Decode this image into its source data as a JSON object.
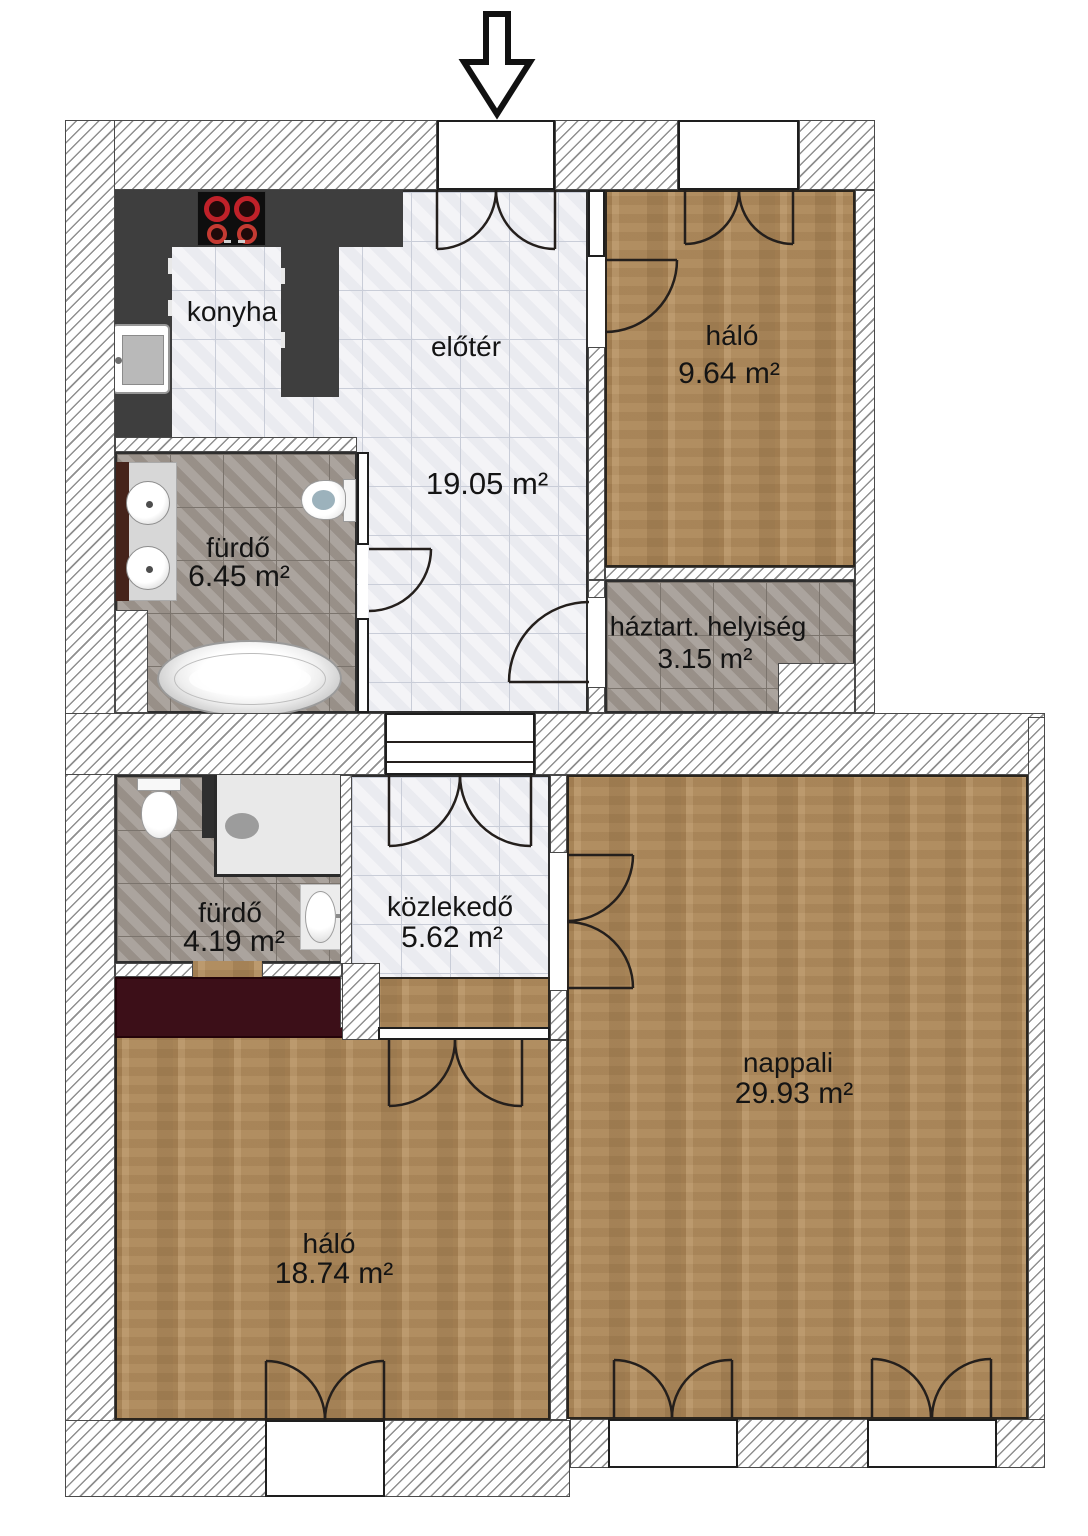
{
  "title": "apartment-floor-plan",
  "rooms": [
    {
      "id": "konyha",
      "name": "konyha",
      "area": ""
    },
    {
      "id": "eloter",
      "name": "előtér",
      "area": "19.05 m²"
    },
    {
      "id": "halo-kis",
      "name": "háló",
      "area": "9.64 m²"
    },
    {
      "id": "furdo-nagy",
      "name": "fürdő",
      "area": "6.45 m²"
    },
    {
      "id": "haztartasi",
      "name": "háztart. helyiség",
      "area": "3.15 m²"
    },
    {
      "id": "furdo-kis",
      "name": "fürdő",
      "area": "4.19 m²"
    },
    {
      "id": "kozlekedo",
      "name": "közlekedő",
      "area": "5.62 m²"
    },
    {
      "id": "nappali",
      "name": "nappali",
      "area": "29.93 m²"
    },
    {
      "id": "halo-nagy",
      "name": "háló",
      "area": "18.74 m²"
    }
  ],
  "fixtures": [
    "entrance-arrow-icon",
    "stove-icon",
    "kitchen-counter",
    "kitchen-sink-icon",
    "vanity-counter",
    "washbasin-icon",
    "washbasin-icon",
    "toilet-icon",
    "bathtub-icon",
    "toilet-icon",
    "shower-icon",
    "shower-drain-icon",
    "bathroom-sink-icon",
    "wardrobe"
  ],
  "colors": {
    "wood_floor": "#b28d5f",
    "light_tile": "#f2f2f6",
    "gray_tile": "#a29a93",
    "wall_hatch_line": "#8f8f8f",
    "kitchen_counter": "#3e3e3e",
    "stove_burner_red": "#bf2129",
    "wardrobe_maroon": "#3c0f18",
    "line": "#1e1e1e"
  }
}
